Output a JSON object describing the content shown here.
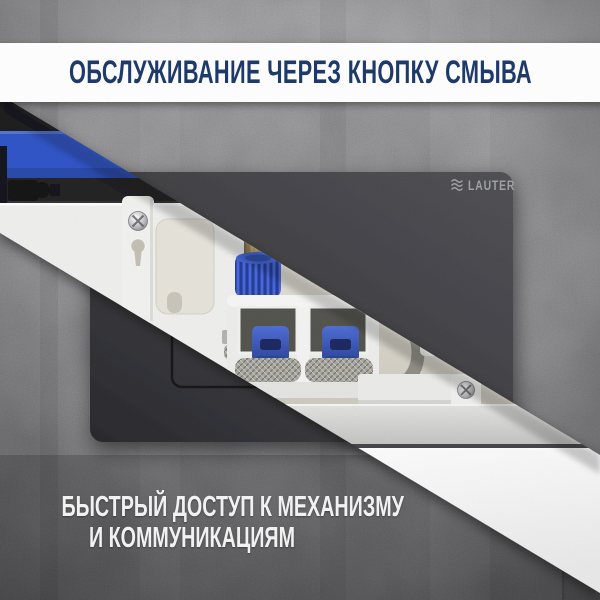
{
  "banner": {
    "title": "ОБСЛУЖИВАНИЕ ЧЕРЕЗ КНОПКУ СМЫВА"
  },
  "plate": {
    "brand": "LAUTER",
    "logo_icon": "wave-icon"
  },
  "caption": {
    "line1": "БЫСТРЫЙ ДОСТУП К МЕХАНИЗМУ",
    "line2": "И КОММУНИКАЦИЯМ"
  },
  "colors": {
    "title_navy": "#1d3a6b",
    "cistern_blue": "#2a50c6",
    "valve_blue": "#3253c2",
    "banner_white": "#fcfcfd",
    "caption_white": "#f1f1f1",
    "plate_dark": "#3a3a3f",
    "concrete_gray": "#77777b",
    "cream_interior": "#ded9cf"
  }
}
